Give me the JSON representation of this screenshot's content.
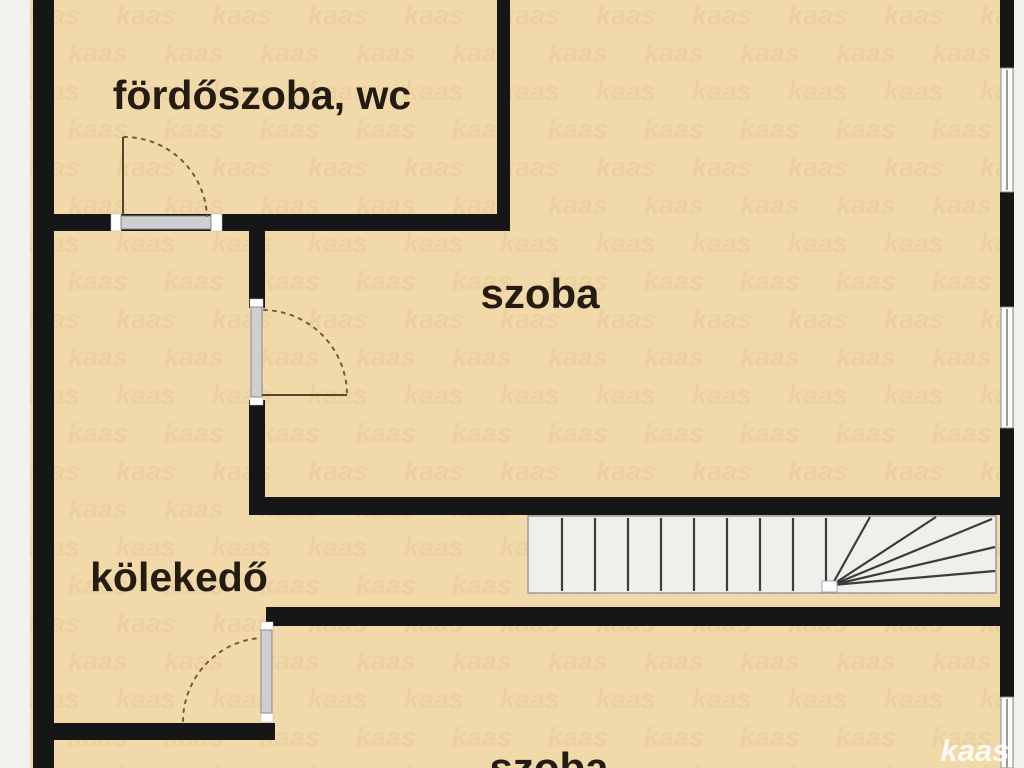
{
  "plan": {
    "rooms": [
      {
        "label": "fördőszoba, wc"
      },
      {
        "label": "szoba"
      },
      {
        "label": "kölekedő"
      },
      {
        "label": "szoba"
      }
    ],
    "branding": {
      "logo": "kaas",
      "watermark_tile": "kaas"
    },
    "colors": {
      "floor": "#f2d9a9",
      "wall": "#161616",
      "margin": "#f2f1ee",
      "door-metal": "#cfcfcf",
      "door-arc": "#6f5b3e",
      "stair-bg": "#f0efec",
      "stair-line": "#3c3c3c",
      "window-glass": "#fcfcfc",
      "window-line": "#9b9b9b",
      "label": "#241b11",
      "watermark": "#e6cb97"
    }
  }
}
